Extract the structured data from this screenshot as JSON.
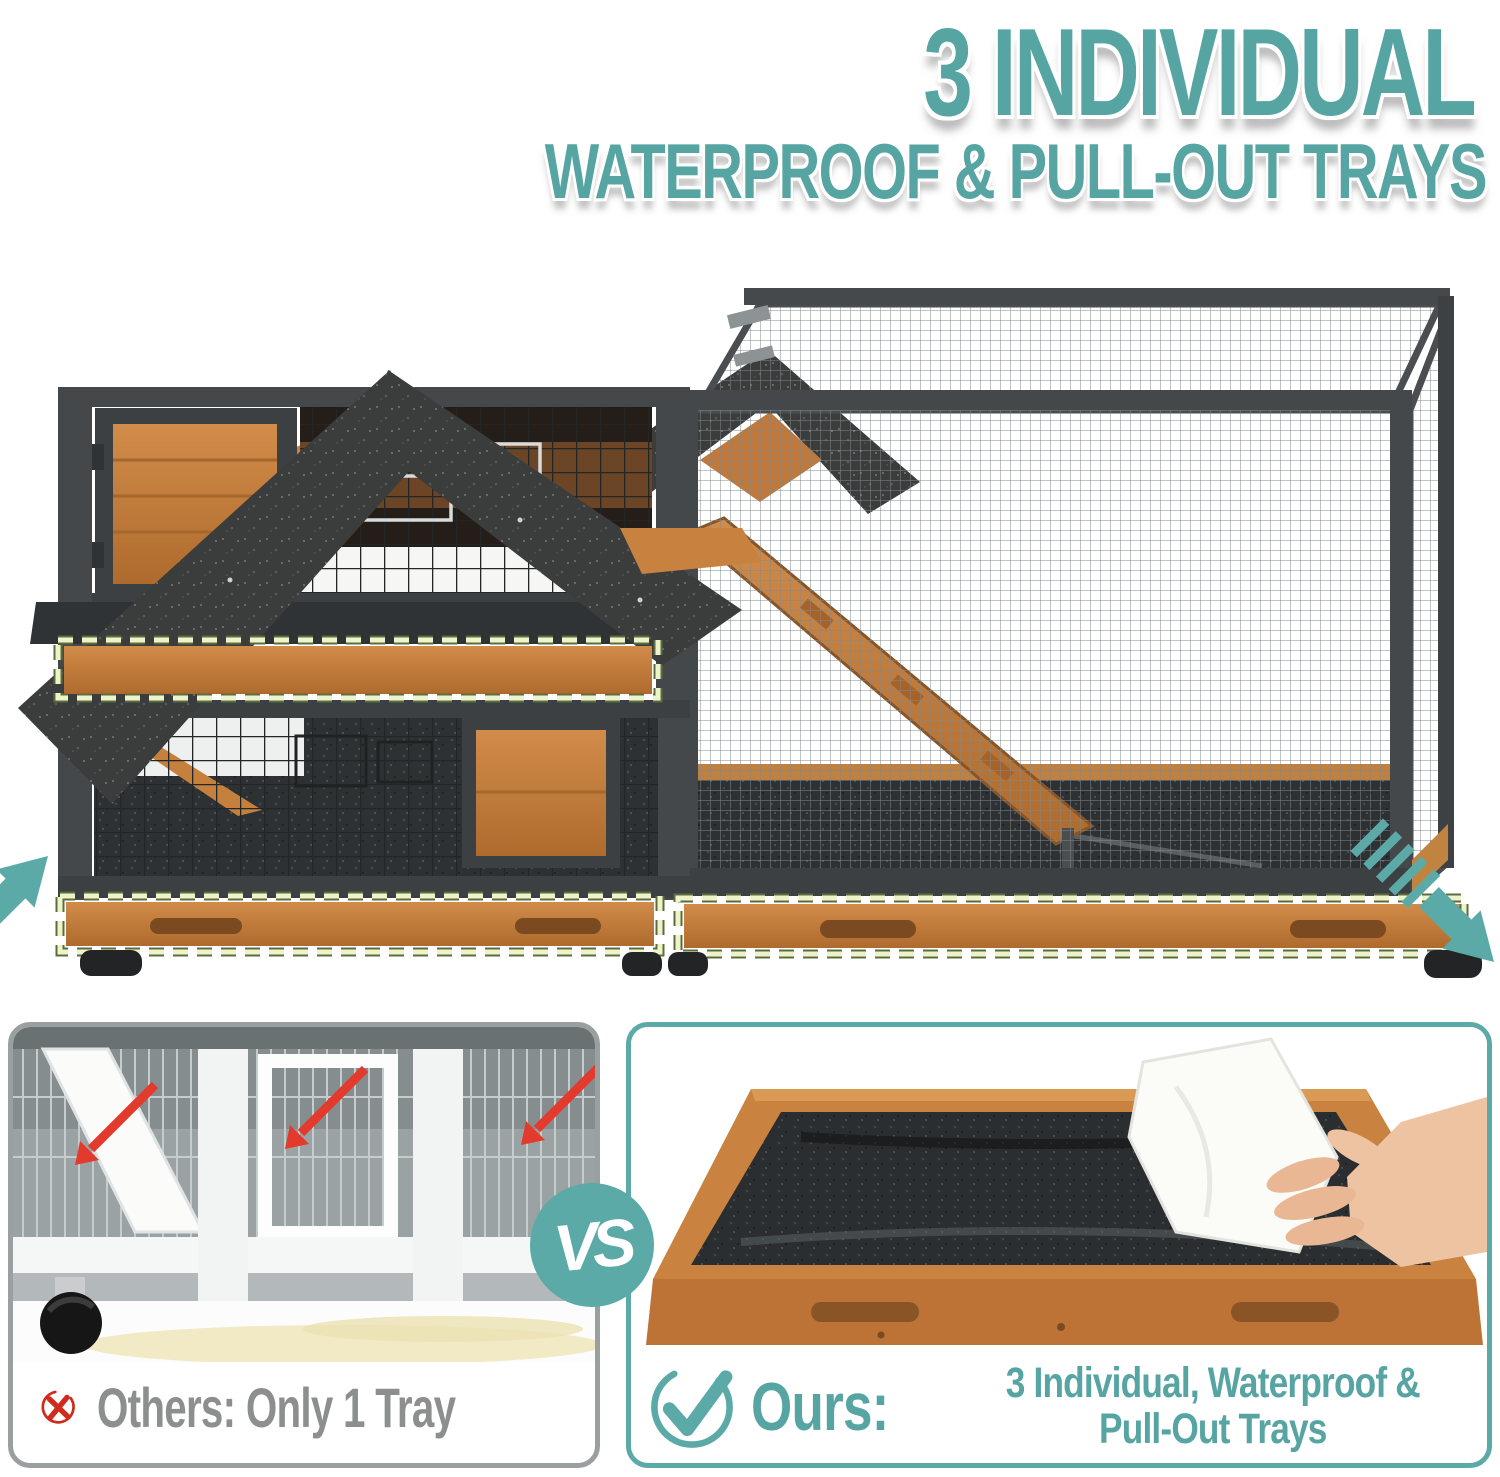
{
  "page": {
    "background": "#ffffff"
  },
  "headline": {
    "line1": "3 INDIVIDUAL",
    "line2": "WATERPROOF & PULL-OUT TRAYS",
    "color": "#57a5a3"
  },
  "hero": {
    "highlighted_trays": 3,
    "dash_color": "#eef4c9",
    "dash_edge_color": "#5c6b40",
    "arrow_color": "#5baaa7",
    "wood_color": "#c9823f",
    "roof_color": "#3a3d3c",
    "frame_color": "#44484a",
    "icons": [
      "pull-out-arrow-up-icon",
      "pull-out-arrow-down-icon"
    ]
  },
  "vs_badge": {
    "label": "VS",
    "background": "#5baaa7",
    "text_color": "#ffffff"
  },
  "comparison": {
    "others": {
      "label": "Others: Only 1 Tray",
      "icon": "x-mark-icon",
      "icon_color": "#cf2a1b",
      "red_arrow_color": "#e23b2e",
      "text_color": "#8d8f8e",
      "border_color": "#9aa0a0"
    },
    "ours": {
      "label": "Ours:",
      "description_line1": "3 Individual, Waterproof &",
      "description_line2": "Pull-Out Trays",
      "icon": "check-icon",
      "accent_color": "#57a5a3",
      "border_color": "#5baaa7"
    }
  }
}
